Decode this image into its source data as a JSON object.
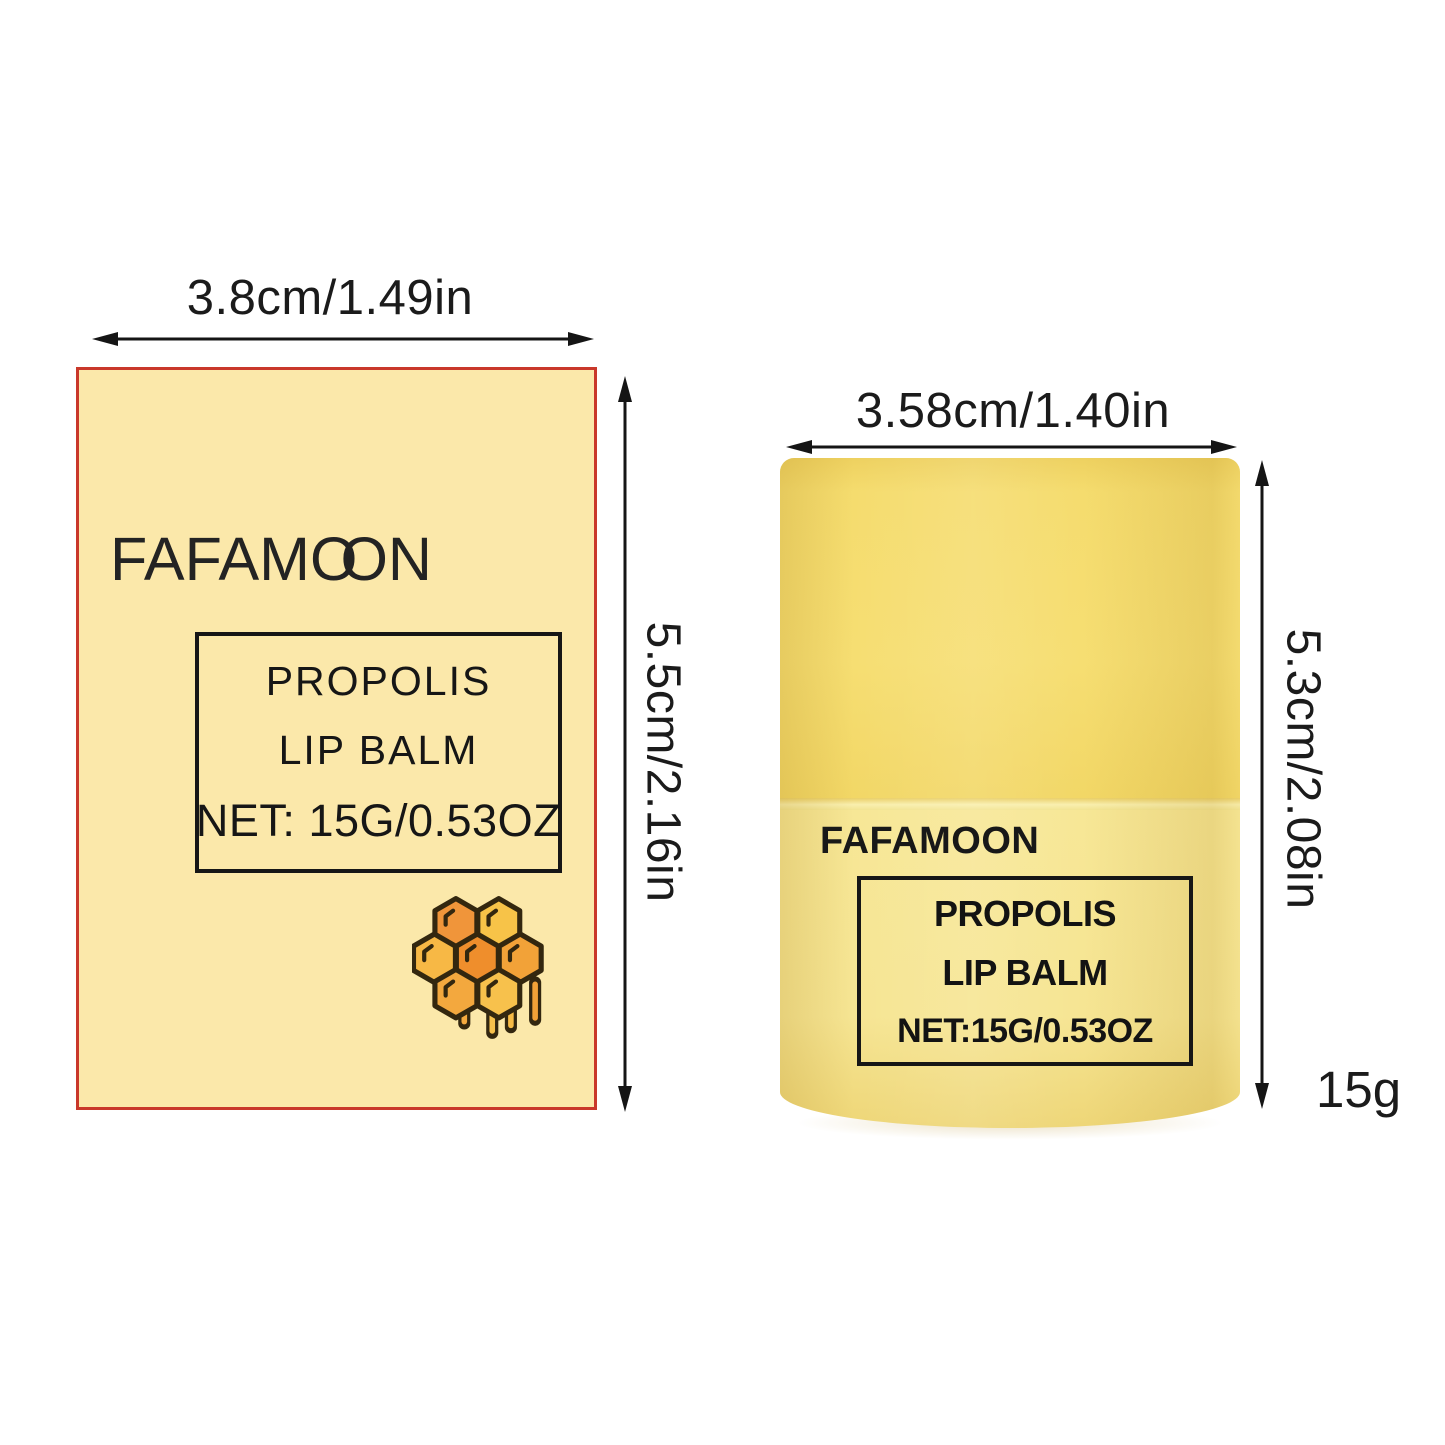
{
  "colors": {
    "background": "#ffffff",
    "text": "#1b1b1b",
    "package_border_red": "#c9382a",
    "package_fill_cream": "#fbe8aa",
    "label_box_border_black": "#161616",
    "tub_cap_yellow": "#f5dc6e",
    "tub_body_yellow": "#f6e593",
    "honey_orange_dark": "#ef8e2c",
    "honey_orange_light": "#f7c348",
    "honey_outline_brown": "#33270f"
  },
  "icons": {
    "honeycomb": "honeycomb-icon"
  },
  "left_group": {
    "width_dimension": "3.8cm/1.49in",
    "height_dimension": "5.5cm/2.16in",
    "package": {
      "brand": {
        "pre": "FAFAM",
        "o1": "O",
        "o2": "O",
        "post": "N"
      },
      "label_line_1": "PROPOLIS",
      "label_line_2": "LIP BALM",
      "label_line_3": "NET: 15G/0.53OZ"
    }
  },
  "right_group": {
    "width_dimension": "3.58cm/1.40in",
    "height_dimension": "5.3cm/2.08in",
    "weight": "15g",
    "tub": {
      "brand": "FAFAMOON",
      "label_line_1": "PROPOLIS",
      "label_line_2": "LIP BALM",
      "label_line_3": "NET:15G/0.53OZ"
    }
  }
}
